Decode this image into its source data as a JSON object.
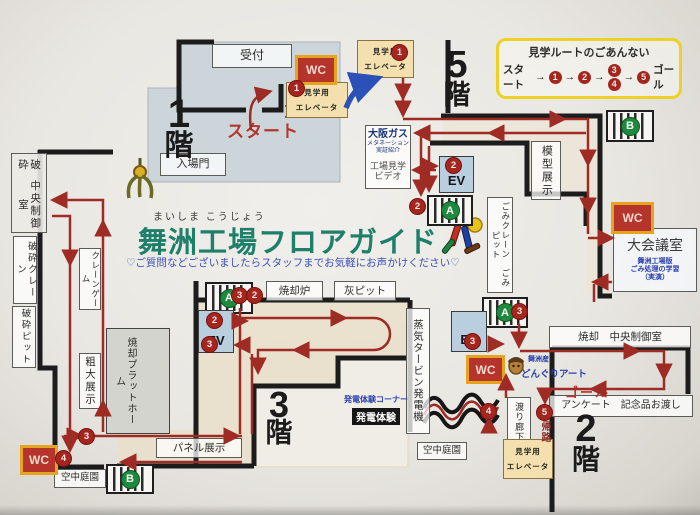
{
  "title": {
    "furigana": "まいしま こうじょう",
    "main": "舞洲工場フロアガイド",
    "subtitle": "♡ご質問などございましたらスタッフまでお気軽にお声かけください♡"
  },
  "legend": {
    "heading": "見学ルートのごあんない",
    "start": "スタート",
    "goal": "ゴール",
    "arrow": "→",
    "n1": "1",
    "n2": "2",
    "n3": "3",
    "n4": "4",
    "n5": "5"
  },
  "floors": {
    "f1": "1",
    "f2": "2",
    "f3": "3",
    "f5": "5",
    "suffix": "階"
  },
  "labels": {
    "reception": "受付",
    "wc": "WC",
    "ev": "EV",
    "elevator_line1": "見学用",
    "elevator_line2": "エレベータ",
    "start": "スタート",
    "gate": "入場門",
    "osaka_gas": "大阪ガス",
    "osaka_gas_sub": "メタネーション実証紹介",
    "video_line1": "工場見学",
    "video_line2": "ビデオ",
    "model": "模型展示",
    "gomi_crane_pit": "ごみクレーン　ごみピット",
    "conference": "大会議室",
    "conference_sub1": "舞洲工場版",
    "conference_sub2": "ごみ処理の学習",
    "conference_sub3": "（実演）",
    "crush": "破砕",
    "central_control": "中央制御室",
    "crush_crane": "破砕クレーン",
    "crush_pit": "破砕ピット",
    "crane_game": "クレーンゲーム",
    "bulky_display": "粗大展示",
    "platform": "焼却プラットホーム",
    "incinerator": "焼却炉",
    "ash_pit": "灰ピット",
    "turbine": "蒸気タービン発電機",
    "power_corner": "発電体験コーナー",
    "power_exp": "発電体験",
    "panel": "パネル展示",
    "sky_garden": "空中庭園",
    "incin_control": "焼却　中央制御室",
    "goal": "ゴール",
    "survey": "アンケート　記念品お渡し",
    "maishima_san": "舞洲産",
    "acorn_art": "どんぐりアート",
    "corridor": "渡り廊下",
    "return_route": "帰路",
    "stairs_a": "A",
    "stairs_b": "B"
  },
  "route_numbers": {
    "n1": "1",
    "n2": "2",
    "n3": "3",
    "n4": "4",
    "n5": "5"
  },
  "colors": {
    "route_red": "#9e2b24",
    "title_teal": "#1e7f6b",
    "subtitle_blue": "#3a50b5",
    "legend_yellow": "#edd126",
    "wc_red": "#b5342c",
    "wc_border": "#e6a31e",
    "ev_blue": "#b9cede",
    "elevator_tan": "#f3e0ae",
    "stairs_green": "#1e8a3e",
    "wall_black": "#1c1c1c",
    "floor1_fill": "#ccd6da",
    "hall_fill": "#e9dfc9"
  }
}
